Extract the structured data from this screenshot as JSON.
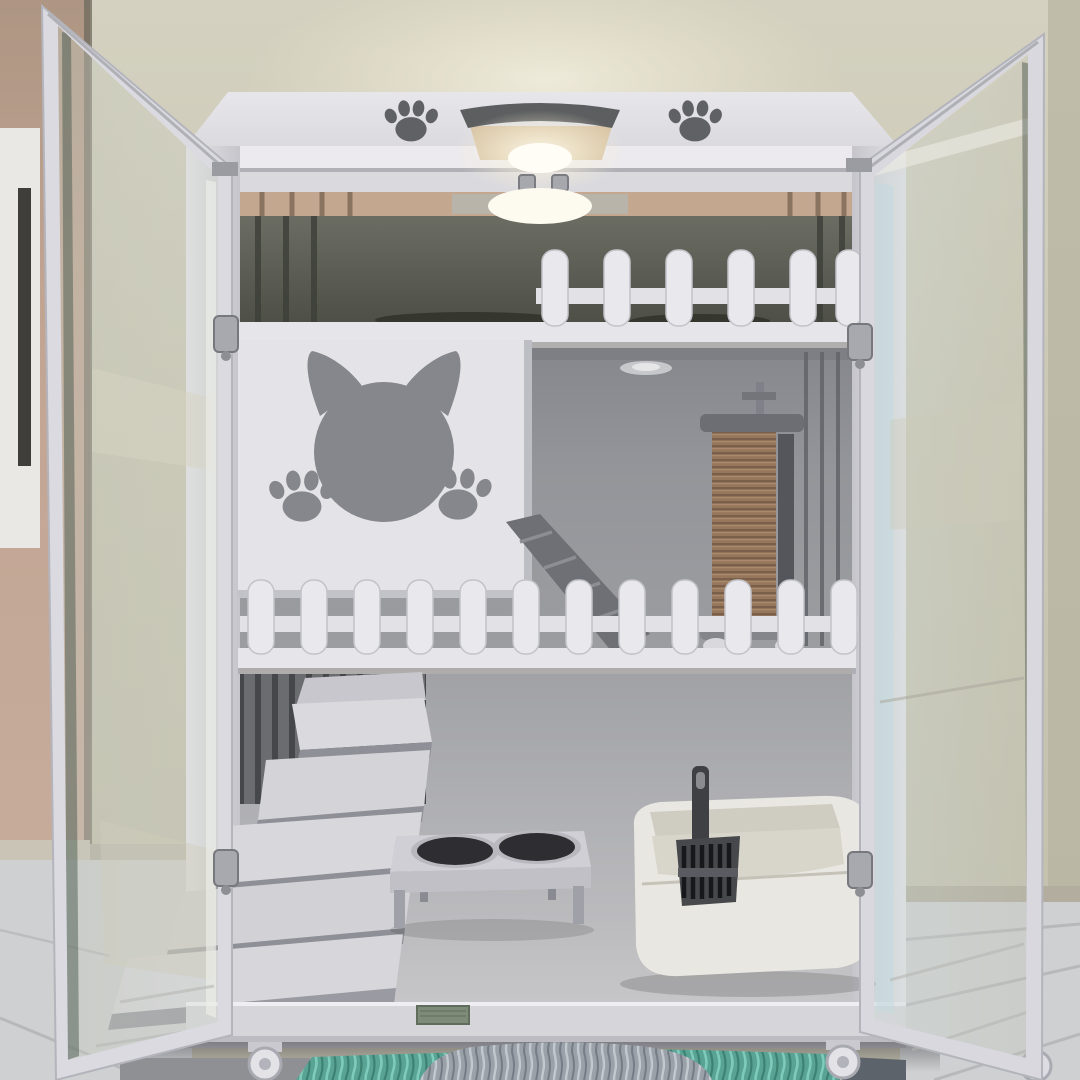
{
  "scene": {
    "description": "Front view photograph of a white three-level cat cabinet (cattery) with both framed glass doors swung open, standing on caster wheels over a teal shaggy rug in a room with olive-beige walls and light grey tile floor",
    "levels": 3,
    "doors_open": 2
  },
  "palette": {
    "wall": "#c9c6b3",
    "wallLight": "#dbd8c7",
    "sideWall": "#bfa292",
    "floorTile": "#cfd0d2",
    "cabinetWhite": "#dfdee3",
    "frameShade": "#c6c6cc",
    "interiorTopDark": "#5c5e55",
    "woodStrip": "#c3a78f",
    "interiorMid": "#95969b",
    "interiorBottom": "#b2b3b7",
    "cutoutGray": "#85878c",
    "pawDark": "#5f6164",
    "sisalBrown": "#96775c",
    "stairTop": "#d7d7db",
    "bowlDark": "#2e2e32",
    "litterCream": "#e9e7e1",
    "scoopDark": "#3f4044",
    "rugTeal": "#58a393",
    "furGray": "#9aa1a9",
    "labelGreen": "#7d8b78",
    "metal": "#a8a9af",
    "lampGlow": "#fffdf6"
  },
  "objects": {
    "wall": {
      "label": "olive-beige room wall"
    },
    "side_wall": {
      "label": "tan side wall with white door jamb"
    },
    "floor": {
      "label": "light grey tile floor"
    },
    "cabinet": {
      "label": "white three-level cat cabinet"
    },
    "top_panel": {
      "label": "cabinet top with paw prints and lamp handle"
    },
    "lamp": {
      "label": "warm lamp glowing on cabinet top"
    },
    "latches": {
      "label": "two metal door catches on top rail"
    },
    "level_top": {
      "label": "upper level with picket fence and interior light"
    },
    "level_middle": {
      "label": "middle level with cat-head panel, ramp and scratching post"
    },
    "level_bottom": {
      "label": "bottom level with stairs, feeder bowls and litter box"
    },
    "cat_panel": {
      "label": "white panel with cat head and paw cutouts"
    },
    "ramp": {
      "label": "grey step ramp between levels"
    },
    "scratch_post": {
      "label": "sisal scratching post"
    },
    "fence_top": {
      "label": "white picket fence on upper level"
    },
    "fence_middle": {
      "label": "white picket fence across middle level"
    },
    "stairs": {
      "label": "white staircase in bottom level"
    },
    "feeder": {
      "label": "raised double food bowl stand"
    },
    "litter_box": {
      "label": "cream litter box with black scoop"
    },
    "base": {
      "label": "cabinet base with green label and casters"
    },
    "rug": {
      "label": "teal shaggy rug with grey fur cushion"
    },
    "left_door": {
      "label": "open glass door, left"
    },
    "right_door": {
      "label": "open glass door, right"
    }
  }
}
